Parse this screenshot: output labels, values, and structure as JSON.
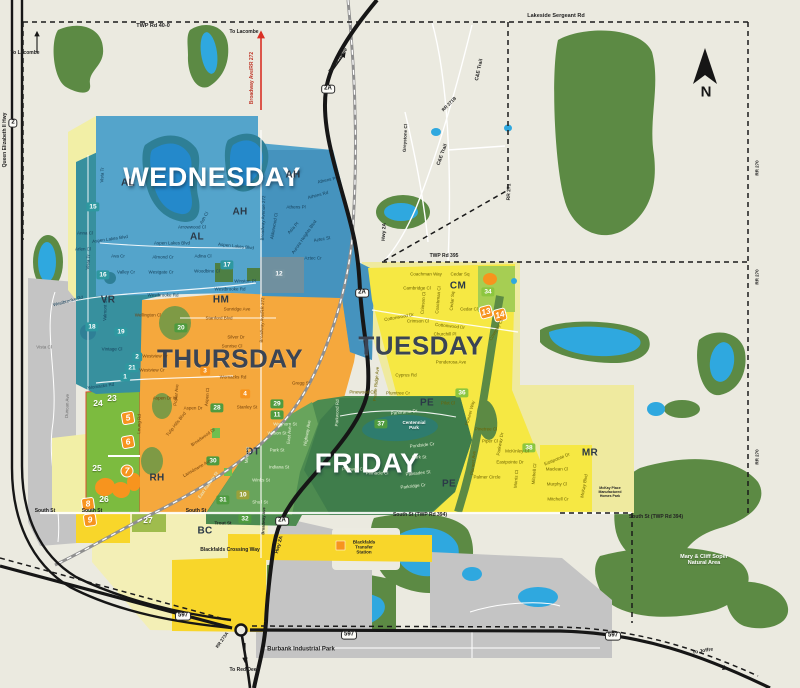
{
  "colors": {
    "bg": "#EBEAE0",
    "park": "#5C8A44",
    "water": "#2FA8DF",
    "wed": "#54A4CB",
    "wed_dark": "#4593BE",
    "vr": "#37909E",
    "slate": "#70909F",
    "thu": "#F5A83D",
    "tue": "#F6E843",
    "tue_pale": "#EFEA9F",
    "fri": "#4D8B50",
    "fri_dark": "#3F7D4B",
    "fri_light": "#68A45C",
    "green_zone": "#7CBB3F",
    "bc_pale": "#F3EFB6",
    "bc_yellow": "#F8D62A",
    "gray": "#C4C4C4",
    "badge_teal": "#2E98A0",
    "badge_green": "#4F9B3F",
    "badge_lightgreen": "#8CC63F",
    "badge_olive": "#9AA13B",
    "badge_orange": "#F7941E",
    "badge_slate": "#7493A0",
    "badge_plain": "",
    "street_wed": "#16415C",
    "street_thu": "#74420C",
    "street_tue": "#6E6300",
    "street_fri": "#E8F2DA",
    "street_gray": "#707070",
    "label_red": "#C0392B",
    "day_dark": "#3A4454",
    "white": "#FFFFFF"
  },
  "compass": {
    "n": "N"
  },
  "day_labels": [
    {
      "t": "WEDNESDAY",
      "x": 212,
      "y": 177,
      "s": 27,
      "c": "#FFFFFF"
    },
    {
      "t": "THURSDAY",
      "x": 230,
      "y": 359,
      "s": 26,
      "c": "#3A4454"
    },
    {
      "t": "TUESDAY",
      "x": 421,
      "y": 346,
      "s": 26,
      "c": "#3A4454"
    },
    {
      "t": "FRIDAY",
      "x": 367,
      "y": 463,
      "s": 28,
      "c": "#FFFFFF"
    }
  ],
  "area_codes": [
    {
      "t": "AL",
      "x": 128,
      "y": 183
    },
    {
      "t": "AH",
      "x": 240,
      "y": 212
    },
    {
      "t": "AL",
      "x": 197,
      "y": 237
    },
    {
      "t": "AH",
      "x": 293,
      "y": 175
    },
    {
      "t": "VR",
      "x": 108,
      "y": 300
    },
    {
      "t": "HM",
      "x": 221,
      "y": 300
    },
    {
      "t": "RH",
      "x": 157,
      "y": 478
    },
    {
      "t": "DT",
      "x": 253,
      "y": 452
    },
    {
      "t": "BC",
      "x": 205,
      "y": 531
    },
    {
      "t": "CM",
      "x": 458,
      "y": 286
    },
    {
      "t": "PE",
      "x": 427,
      "y": 403
    },
    {
      "t": "PE",
      "x": 449,
      "y": 484
    },
    {
      "t": "MR",
      "x": 590,
      "y": 453
    }
  ],
  "badges": [
    {
      "t": "15",
      "x": 93,
      "y": 207,
      "bg": "teal"
    },
    {
      "t": "16",
      "x": 103,
      "y": 275,
      "bg": "teal"
    },
    {
      "t": "17",
      "x": 227,
      "y": 265,
      "bg": "teal"
    },
    {
      "t": "12",
      "x": 279,
      "y": 274,
      "bg": "slate"
    },
    {
      "t": "18",
      "x": 92,
      "y": 327,
      "bg": "teal"
    },
    {
      "t": "19",
      "x": 121,
      "y": 332,
      "bg": "teal"
    },
    {
      "t": "2",
      "x": 137,
      "y": 357,
      "bg": "teal"
    },
    {
      "t": "21",
      "x": 132,
      "y": 368,
      "bg": "teal"
    },
    {
      "t": "1",
      "x": 125,
      "y": 377,
      "bg": "teal"
    },
    {
      "t": "20",
      "x": 181,
      "y": 328,
      "bg": "green"
    },
    {
      "t": "3",
      "x": 205,
      "y": 371,
      "bg": "orange"
    },
    {
      "t": "4",
      "x": 245,
      "y": 394,
      "bg": "orange"
    },
    {
      "t": "28",
      "x": 217,
      "y": 408,
      "bg": "green"
    },
    {
      "t": "29",
      "x": 277,
      "y": 404,
      "bg": "green"
    },
    {
      "t": "11",
      "x": 277,
      "y": 415,
      "bg": "green"
    },
    {
      "t": "30",
      "x": 213,
      "y": 461,
      "bg": "green"
    },
    {
      "t": "31",
      "x": 223,
      "y": 500,
      "bg": "green"
    },
    {
      "t": "10",
      "x": 243,
      "y": 495,
      "bg": "olive"
    },
    {
      "t": "32",
      "x": 245,
      "y": 519,
      "bg": "green"
    },
    {
      "t": "34",
      "x": 488,
      "y": 292,
      "bg": "lightgreen"
    },
    {
      "t": "36",
      "x": 462,
      "y": 393,
      "bg": "lightgreen"
    },
    {
      "t": "37",
      "x": 381,
      "y": 424,
      "bg": "green"
    },
    {
      "t": "38",
      "x": 529,
      "y": 448,
      "bg": "lightgreen"
    },
    {
      "t": "24",
      "x": 98,
      "y": 404,
      "bg": "plain"
    },
    {
      "t": "23",
      "x": 112,
      "y": 399,
      "bg": "plain"
    },
    {
      "t": "25",
      "x": 97,
      "y": 469,
      "bg": "plain"
    },
    {
      "t": "26",
      "x": 104,
      "y": 500,
      "bg": "plain"
    },
    {
      "t": "27",
      "x": 148,
      "y": 521,
      "bg": "plain"
    }
  ],
  "route_markers": [
    {
      "t": "5",
      "x": 128,
      "y": 418,
      "r": -10
    },
    {
      "t": "6",
      "x": 128,
      "y": 442,
      "r": -10
    },
    {
      "t": "7",
      "x": 127,
      "y": 471,
      "r": 0,
      "rd": 1
    },
    {
      "t": "8",
      "x": 88,
      "y": 504,
      "r": -8
    },
    {
      "t": "9",
      "x": 90,
      "y": 520,
      "r": -8
    },
    {
      "t": "13",
      "x": 486,
      "y": 312,
      "r": -15
    },
    {
      "t": "14",
      "x": 500,
      "y": 315,
      "r": -15
    }
  ],
  "shields": [
    {
      "t": "2",
      "x": 13,
      "y": 123
    },
    {
      "t": "2A",
      "x": 328,
      "y": 89
    },
    {
      "t": "2A",
      "x": 362,
      "y": 293
    },
    {
      "t": "2A",
      "x": 282,
      "y": 521
    },
    {
      "t": "597",
      "x": 183,
      "y": 616
    },
    {
      "t": "597",
      "x": 349,
      "y": 635
    },
    {
      "t": "597",
      "x": 613,
      "y": 636
    }
  ],
  "map_labels": [
    {
      "t": "TWP Rd 40-0",
      "x": 153,
      "y": 26,
      "s": 5.5
    },
    {
      "t": "Lakeside Sergeant Rd",
      "x": 556,
      "y": 16,
      "s": 5.5
    },
    {
      "t": "To Lacombe",
      "x": 25,
      "y": 54
    },
    {
      "t": "To Lacombe",
      "x": 244,
      "y": 33
    },
    {
      "t": "To Lacombe",
      "x": 339,
      "y": 61,
      "r": -55
    },
    {
      "t": "Broadway Ave/RR 272",
      "x": 253,
      "y": 78,
      "r": -90,
      "c": "label_red"
    },
    {
      "t": "Queen Elizabeth II Hwy",
      "x": 6,
      "y": 140,
      "r": -90
    },
    {
      "t": "C&E Trail",
      "x": 480,
      "y": 70,
      "r": -78
    },
    {
      "t": "C&E Trail",
      "x": 443,
      "y": 155,
      "r": -70
    },
    {
      "t": "RR 271B",
      "x": 449,
      "y": 104,
      "r": -45,
      "s": 4.5
    },
    {
      "t": "Greystone Cl",
      "x": 405,
      "y": 138,
      "r": -87,
      "s": 4.5
    },
    {
      "t": "RR 271",
      "x": 510,
      "y": 192,
      "r": -88
    },
    {
      "t": "RR 270",
      "x": 757,
      "y": 168,
      "r": -90,
      "s": 4.5
    },
    {
      "t": "RR 270",
      "x": 757,
      "y": 277,
      "r": -90,
      "s": 4.5
    },
    {
      "t": "RR 270",
      "x": 757,
      "y": 457,
      "r": -90,
      "s": 4.5
    },
    {
      "t": "TWP Rd 395",
      "x": 444,
      "y": 257
    },
    {
      "t": "Hwy 2A",
      "x": 385,
      "y": 232,
      "r": -87
    },
    {
      "t": "Hwy 2A",
      "x": 280,
      "y": 545,
      "r": -75
    },
    {
      "t": "South St",
      "x": 45,
      "y": 512
    },
    {
      "t": "South St",
      "x": 92,
      "y": 512
    },
    {
      "t": "South St",
      "x": 196,
      "y": 512
    },
    {
      "t": "South St (TWP Rd 394)",
      "x": 420,
      "y": 516
    },
    {
      "t": "South St (TWP Rd 394)",
      "x": 656,
      "y": 518
    },
    {
      "t": "Trout St",
      "x": 223,
      "y": 523,
      "s": 4.5
    },
    {
      "t": "Broadway Ave",
      "x": 264,
      "y": 521,
      "r": -88,
      "s": 4
    },
    {
      "t": "Blackfalds Crossing Way",
      "x": 230,
      "y": 551
    },
    {
      "t": "Blackfalds\nTransfer\nStation",
      "x": 364,
      "y": 547,
      "s": 4.5
    },
    {
      "t": "Burbank Industrial Park",
      "x": 301,
      "y": 650,
      "s": 6
    },
    {
      "t": "To Red Deer",
      "x": 244,
      "y": 671
    },
    {
      "t": "To Joffre",
      "x": 703,
      "y": 652,
      "r": -10
    },
    {
      "t": "RR 273A",
      "x": 222,
      "y": 640,
      "r": -55,
      "s": 4.5
    },
    {
      "t": "McKay Place\nManufactured\nHomes Park",
      "x": 610,
      "y": 493,
      "s": 3.5
    },
    {
      "t": "Mary & Cliff Soper\nNatural Area",
      "x": 704,
      "y": 560,
      "s": 5.5,
      "w": 1
    },
    {
      "t": "Centennial\nPark",
      "x": 414,
      "y": 425,
      "s": 4.5,
      "w": 1
    }
  ],
  "street_labels": [
    {
      "t": "Vista Tr",
      "x": 102,
      "y": 175,
      "r": -88,
      "z": "wed"
    },
    {
      "t": "Anna Cl",
      "x": 85,
      "y": 233,
      "z": "wed"
    },
    {
      "t": "Aspen Lakes Blvd",
      "x": 110,
      "y": 239,
      "r": -8,
      "z": "wed"
    },
    {
      "t": "Aspen Lakes Blvd",
      "x": 172,
      "y": 243,
      "z": "wed"
    },
    {
      "t": "Aspen Lakes Blvd",
      "x": 236,
      "y": 246,
      "r": 6,
      "z": "wed"
    },
    {
      "t": "Arlen Cl",
      "x": 83,
      "y": 249,
      "z": "wed"
    },
    {
      "t": "Ava Cr",
      "x": 118,
      "y": 256,
      "z": "wed"
    },
    {
      "t": "Vista Tr",
      "x": 88,
      "y": 262,
      "r": -85,
      "z": "wed"
    },
    {
      "t": "Valley Cr",
      "x": 126,
      "y": 272,
      "z": "wed"
    },
    {
      "t": "Westgate Cr",
      "x": 161,
      "y": 272,
      "z": "wed"
    },
    {
      "t": "Almond Cr",
      "x": 163,
      "y": 257,
      "z": "wed"
    },
    {
      "t": "Arrowwood Cl",
      "x": 192,
      "y": 227,
      "z": "wed"
    },
    {
      "t": "Ash Cl",
      "x": 204,
      "y": 218,
      "r": -62,
      "z": "wed"
    },
    {
      "t": "Adina Cl",
      "x": 203,
      "y": 256,
      "z": "wed"
    },
    {
      "t": "Woodbine Cl",
      "x": 207,
      "y": 271,
      "z": "wed"
    },
    {
      "t": "Winston Pl",
      "x": 245,
      "y": 281,
      "z": "wed"
    },
    {
      "t": "Westbrooke Rd",
      "x": 230,
      "y": 289,
      "z": "wed"
    },
    {
      "t": "Westbrooke Rd",
      "x": 163,
      "y": 295,
      "z": "wed"
    },
    {
      "t": "Westbrooke Rd",
      "x": 68,
      "y": 301,
      "r": -15,
      "z": "wed"
    },
    {
      "t": "Athens Pl",
      "x": 327,
      "y": 180,
      "r": -12,
      "z": "wed"
    },
    {
      "t": "Athens Rd",
      "x": 318,
      "y": 195,
      "r": -15,
      "z": "wed"
    },
    {
      "t": "Athens Pl",
      "x": 296,
      "y": 207,
      "z": "wed"
    },
    {
      "t": "Alderwood Cl",
      "x": 274,
      "y": 226,
      "r": -80,
      "z": "wed"
    },
    {
      "t": "Asia Pl",
      "x": 293,
      "y": 228,
      "r": -48,
      "z": "wed"
    },
    {
      "t": "Aurora Heights Blvd",
      "x": 304,
      "y": 237,
      "r": -55,
      "z": "wed"
    },
    {
      "t": "Aztec St",
      "x": 322,
      "y": 239,
      "r": -10,
      "z": "wed"
    },
    {
      "t": "Aztec Cr",
      "x": 313,
      "y": 258,
      "z": "wed"
    },
    {
      "t": "Broadway Avenue 272",
      "x": 263,
      "y": 218,
      "r": -88,
      "z": "wed"
    },
    {
      "t": "Valmont St",
      "x": 105,
      "y": 310,
      "r": -88,
      "z": "wed"
    },
    {
      "t": "Vintage Cl",
      "x": 112,
      "y": 349,
      "z": "wed"
    },
    {
      "t": "Womacks Rd",
      "x": 101,
      "y": 386,
      "r": -8,
      "z": "wed"
    },
    {
      "t": "Vista Cl",
      "x": 44,
      "y": 347,
      "z": "gray"
    },
    {
      "t": "Duncan Ave",
      "x": 67,
      "y": 406,
      "r": -88,
      "z": "gray"
    },
    {
      "t": "Wellington Cl",
      "x": 148,
      "y": 315,
      "z": "thu"
    },
    {
      "t": "Sunridge Ave",
      "x": 237,
      "y": 309,
      "z": "thu"
    },
    {
      "t": "Stanford Blvd",
      "x": 219,
      "y": 318,
      "z": "thu"
    },
    {
      "t": "Silver Dr",
      "x": 236,
      "y": 337,
      "z": "thu"
    },
    {
      "t": "Sunrise Cl",
      "x": 232,
      "y": 346,
      "z": "thu"
    },
    {
      "t": "Westview Cr",
      "x": 155,
      "y": 356,
      "z": "thu"
    },
    {
      "t": "Westview Cr",
      "x": 152,
      "y": 370,
      "z": "thu"
    },
    {
      "t": "Womacks Rd",
      "x": 233,
      "y": 377,
      "z": "thu"
    },
    {
      "t": "Stanley St",
      "x": 247,
      "y": 407,
      "z": "thu"
    },
    {
      "t": "Aspen Dr W",
      "x": 165,
      "y": 398,
      "z": "thu"
    },
    {
      "t": "Poplar Ave",
      "x": 176,
      "y": 395,
      "r": -85,
      "z": "thu"
    },
    {
      "t": "Aspen Cl",
      "x": 207,
      "y": 397,
      "r": -85,
      "z": "thu"
    },
    {
      "t": "Aspen Dr",
      "x": 193,
      "y": 408,
      "z": "thu"
    },
    {
      "t": "Gregg St",
      "x": 301,
      "y": 383,
      "z": "thu"
    },
    {
      "t": "Broadway Ave/RR 272",
      "x": 262,
      "y": 320,
      "r": -88,
      "z": "thu"
    },
    {
      "t": "Leung Rd",
      "x": 139,
      "y": 424,
      "r": -88,
      "z": "thu"
    },
    {
      "t": "Tulip Hills Blvd",
      "x": 176,
      "y": 424,
      "r": -52,
      "z": "thu"
    },
    {
      "t": "Broadwood Dr",
      "x": 203,
      "y": 437,
      "r": -35,
      "z": "thu"
    },
    {
      "t": "Lansdowne Ave",
      "x": 197,
      "y": 468,
      "r": -30,
      "z": "thu"
    },
    {
      "t": "Coachman Way",
      "x": 426,
      "y": 274,
      "z": "tue"
    },
    {
      "t": "Cedar Sq",
      "x": 460,
      "y": 274,
      "z": "tue"
    },
    {
      "t": "Cambridge Cl",
      "x": 417,
      "y": 288,
      "z": "tue"
    },
    {
      "t": "Crimson Cl",
      "x": 423,
      "y": 303,
      "r": -85,
      "z": "tue"
    },
    {
      "t": "Coachman Cl",
      "x": 438,
      "y": 300,
      "r": -85,
      "z": "tue"
    },
    {
      "t": "Cedar Sq",
      "x": 452,
      "y": 301,
      "r": -85,
      "z": "tue"
    },
    {
      "t": "Crimson Cl",
      "x": 418,
      "y": 321,
      "z": "tue"
    },
    {
      "t": "Cottonwood Dr",
      "x": 399,
      "y": 317,
      "r": -10,
      "z": "tue"
    },
    {
      "t": "Cottonwood Dr",
      "x": 450,
      "y": 326,
      "r": 6,
      "z": "tue"
    },
    {
      "t": "Cedar Cl",
      "x": 469,
      "y": 309,
      "z": "tue"
    },
    {
      "t": "Churchill Pl",
      "x": 445,
      "y": 334,
      "z": "tue"
    },
    {
      "t": "Coventry Cl",
      "x": 496,
      "y": 330,
      "r": -60,
      "z": "tue"
    },
    {
      "t": "Ponderosa Ave",
      "x": 451,
      "y": 362,
      "z": "tue"
    },
    {
      "t": "Cyprus Rd",
      "x": 406,
      "y": 375,
      "z": "tue"
    },
    {
      "t": "Prairie Ridge Ave",
      "x": 376,
      "y": 384,
      "r": -85,
      "z": "tue"
    },
    {
      "t": "Pinewood Cl",
      "x": 362,
      "y": 392,
      "z": "tue"
    },
    {
      "t": "Plumtree Cr",
      "x": 398,
      "y": 393,
      "z": "tue"
    },
    {
      "t": "Pilot Cl",
      "x": 448,
      "y": 403,
      "z": "tue"
    },
    {
      "t": "Pioneer Way",
      "x": 470,
      "y": 413,
      "r": -75,
      "z": "tue"
    },
    {
      "t": "Pinetree Cl",
      "x": 486,
      "y": 429,
      "z": "tue"
    },
    {
      "t": "Piper Cl",
      "x": 490,
      "y": 441,
      "z": "tue"
    },
    {
      "t": "Parkway Dr",
      "x": 500,
      "y": 444,
      "r": -80,
      "z": "tue"
    },
    {
      "t": "McKinley Cl",
      "x": 517,
      "y": 451,
      "z": "tue"
    },
    {
      "t": "Eastpointe Dr",
      "x": 510,
      "y": 462,
      "z": "tue"
    },
    {
      "t": "Eastpointe Dr",
      "x": 557,
      "y": 459,
      "r": -22,
      "z": "tue"
    },
    {
      "t": "Pioneer Ave",
      "x": 473,
      "y": 463,
      "r": -85,
      "z": "tue"
    },
    {
      "t": "Palmer Circle",
      "x": 487,
      "y": 477,
      "z": "tue"
    },
    {
      "t": "Morris Cl",
      "x": 516,
      "y": 479,
      "r": -85,
      "z": "tue"
    },
    {
      "t": "Mitchell Cl",
      "x": 534,
      "y": 474,
      "r": -85,
      "z": "tue"
    },
    {
      "t": "Maclean Cl",
      "x": 557,
      "y": 469,
      "z": "tue"
    },
    {
      "t": "Murphy Cl",
      "x": 557,
      "y": 484,
      "z": "tue"
    },
    {
      "t": "Mitchell Cr",
      "x": 558,
      "y": 499,
      "z": "tue"
    },
    {
      "t": "McKay Blvd",
      "x": 584,
      "y": 486,
      "r": -80,
      "z": "tue"
    },
    {
      "t": "Waghorn St",
      "x": 285,
      "y": 424,
      "z": "fri"
    },
    {
      "t": "Wilson St",
      "x": 277,
      "y": 433,
      "z": "fri"
    },
    {
      "t": "Park St",
      "x": 277,
      "y": 450,
      "z": "fri"
    },
    {
      "t": "Indiana St",
      "x": 279,
      "y": 467,
      "z": "fri"
    },
    {
      "t": "Winks St",
      "x": 261,
      "y": 480,
      "z": "fri"
    },
    {
      "t": "Shull St",
      "x": 260,
      "y": 502,
      "z": "fri"
    },
    {
      "t": "Minto St",
      "x": 247,
      "y": 455,
      "r": -85,
      "z": "fri"
    },
    {
      "t": "East Ave",
      "x": 289,
      "y": 435,
      "r": -85,
      "z": "fri"
    },
    {
      "t": "Highway Ave",
      "x": 307,
      "y": 433,
      "r": -80,
      "z": "fri"
    },
    {
      "t": "Parkwood Rd",
      "x": 337,
      "y": 413,
      "r": -88,
      "z": "fri"
    },
    {
      "t": "East Railway St",
      "x": 208,
      "y": 485,
      "r": -55,
      "z": "fri"
    },
    {
      "t": "Panorama Dr",
      "x": 404,
      "y": 412,
      "r": -6,
      "z": "fri"
    },
    {
      "t": "Pondside Cr",
      "x": 422,
      "y": 445,
      "r": -6,
      "z": "fri"
    },
    {
      "t": "Park St",
      "x": 419,
      "y": 457,
      "z": "fri"
    },
    {
      "t": "Palisades St",
      "x": 418,
      "y": 473,
      "r": -6,
      "z": "fri"
    },
    {
      "t": "Pinnacle Cl",
      "x": 377,
      "y": 473,
      "z": "fri"
    },
    {
      "t": "Portway Cl",
      "x": 353,
      "y": 469,
      "z": "fri"
    },
    {
      "t": "Parkridge Cr",
      "x": 413,
      "y": 486,
      "r": -6,
      "z": "fri"
    }
  ]
}
